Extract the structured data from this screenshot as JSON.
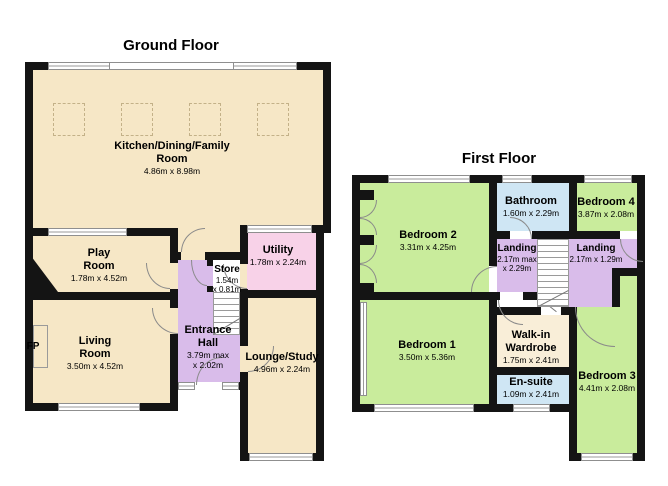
{
  "colors": {
    "cream": "#f6e7c6",
    "purple": "#d9bcea",
    "pink": "#f8d2e8",
    "green": "#c9ec9c",
    "blue": "#cfe6f4",
    "wardrobe_cream": "#f9eed8",
    "wall": "#141414"
  },
  "ground_floor": {
    "title": "Ground Floor",
    "rooms": {
      "kitchen": {
        "name": "Kitchen/Dining/Family\nRoom",
        "dims": "4.86m x 8.98m"
      },
      "play": {
        "name": "Play\nRoom",
        "dims": "1.78m x 4.52m"
      },
      "living": {
        "name": "Living\nRoom",
        "dims": "3.50m x 4.52m"
      },
      "utility": {
        "name": "Utility",
        "dims": "1.78m x 2.24m"
      },
      "store": {
        "name": "Store",
        "dims": "1.54m\nx 0.81m"
      },
      "hall": {
        "name": "Entrance\nHall",
        "dims": "3.79m max\nx 2.02m"
      },
      "lounge": {
        "name": "Lounge/Study",
        "dims": "4.96m x 2.24m"
      },
      "fireplace": {
        "name": "FP"
      }
    }
  },
  "first_floor": {
    "title": "First Floor",
    "rooms": {
      "bedroom2": {
        "name": "Bedroom 2",
        "dims": "3.31m x 4.25m"
      },
      "bathroom": {
        "name": "Bathroom",
        "dims": "1.60m x 2.29m"
      },
      "bedroom4": {
        "name": "Bedroom 4",
        "dims": "3.87m x 2.08m"
      },
      "landing_left": {
        "name": "Landing",
        "dims": "2.17m max\nx 2.29m"
      },
      "landing_right": {
        "name": "Landing",
        "dims": "2.17m x 1.29m"
      },
      "bedroom1": {
        "name": "Bedroom 1",
        "dims": "3.50m x 5.36m"
      },
      "wardrobe": {
        "name": "Walk-in\nWardrobe",
        "dims": "1.75m x 2.41m"
      },
      "ensuite": {
        "name": "En-suite",
        "dims": "1.09m x 2.41m"
      },
      "bedroom3": {
        "name": "Bedroom 3",
        "dims": "4.41m x 2.08m"
      }
    }
  }
}
